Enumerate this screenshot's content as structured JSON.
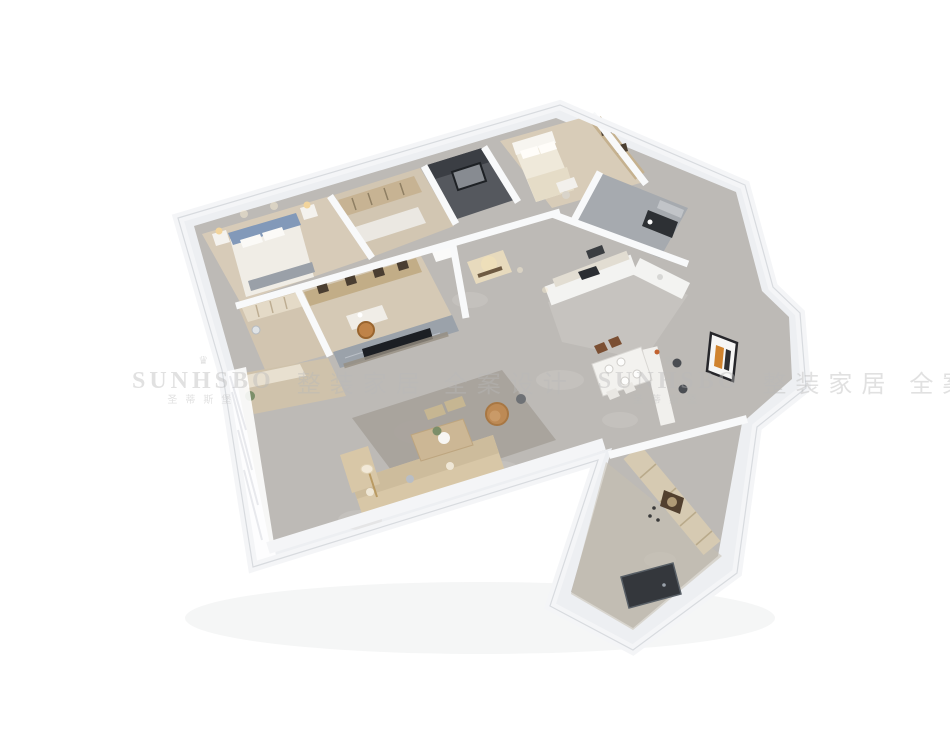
{
  "canvas": {
    "width": 950,
    "height": 733,
    "background": "#ffffff"
  },
  "watermark": {
    "crown_glyph": "♛",
    "brand": "SUNHSBO",
    "brand_zh": "圣蒂斯堡",
    "slogan": "整装家居 全案设计",
    "tint": "#b9b9b9"
  },
  "scene": {
    "kind": "isometric-3d-floorplan-render",
    "rooms": [
      "master-bedroom",
      "walk-in-closet",
      "dressing-hall",
      "dark-bathroom",
      "second-bedroom",
      "corner-bathroom",
      "study",
      "hallway",
      "kitchen",
      "dining-room",
      "living-room",
      "balcony",
      "entry-corridor"
    ],
    "palette": {
      "outer_wall": "#edeff2",
      "wall_band": "#f4f5f7",
      "wall_outline": "#d8dbdf",
      "marble_floor": "#bdbab6",
      "wood_floor": "#d5c9b6",
      "dark_bath": "#55585e",
      "gray_bath": "#a6aaaf",
      "bed_headboard_blue": "#8299b9",
      "cream_bed": "#efe9da",
      "sofa_beige": "#d8c7a7",
      "armchair_tan": "#bd8a55",
      "cabinet_wood": "#d6cab2",
      "bookshelf_wood": "#c2ad87",
      "art_orange": "#d0832e",
      "tv_black": "#1c1f24",
      "entry_door": "#34373c",
      "warm_light": "#f4e3b8",
      "plant_green": "#7c8e69"
    }
  }
}
